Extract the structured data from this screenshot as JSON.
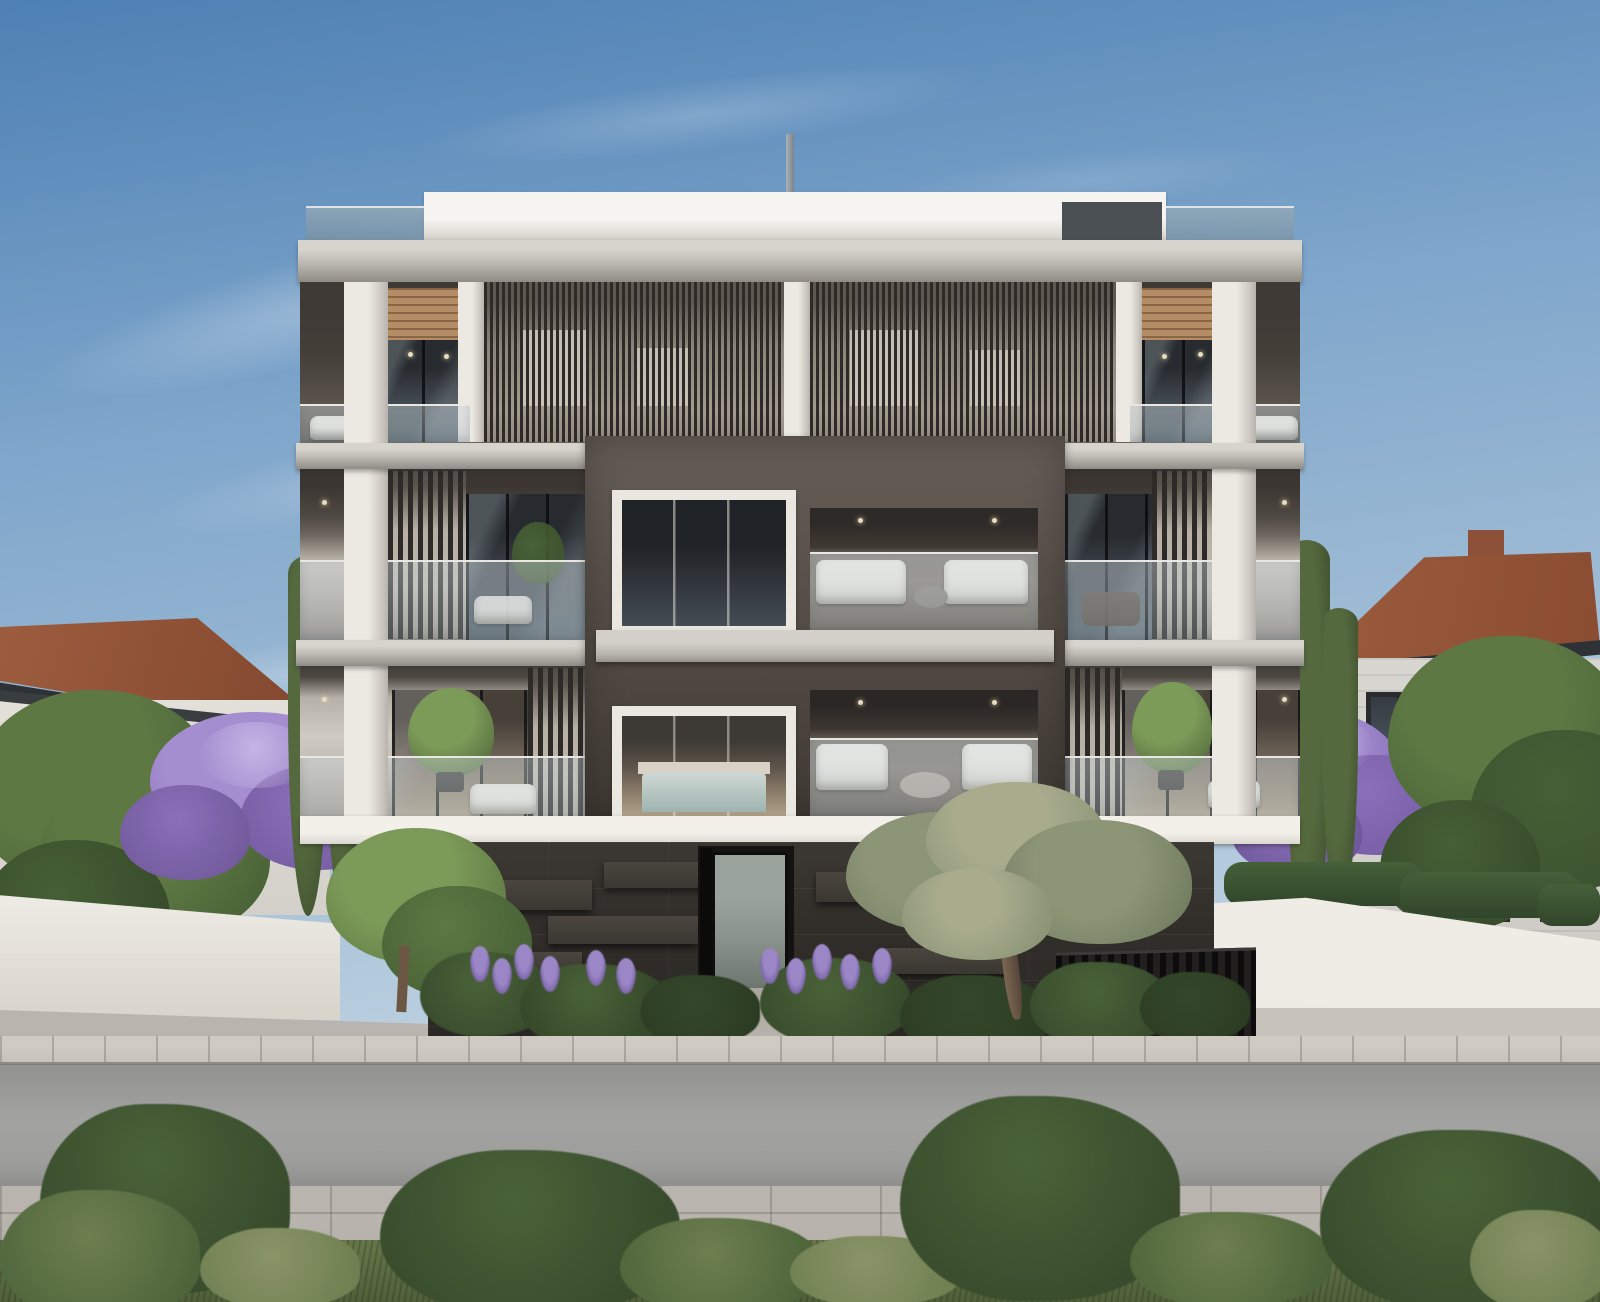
{
  "scene": {
    "type": "photorealistic architectural exterior rendering",
    "subject": "Modern three-storey apartment building with white concrete slabs, dark vertical louvers, timber soffits, glass balustrades and a protruding dark frame volume over a black stone base",
    "setting": "Residential street: neighbouring terracotta-roofed houses left and right, cypress and jacaranda trees, white boundary walls, landscaped front garden with olive tree and lavender, sidewalk, asphalt road and grass verge with shrubs in the foreground",
    "elements": [
      "sky",
      "clouds",
      "antenna pole",
      "roof parapet",
      "glass roof railing",
      "concrete slabs",
      "white columns",
      "timber soffit",
      "vertical louver screens",
      "glass door walls",
      "balcony glass balustrades",
      "balcony sofas",
      "potted trees",
      "central dark frame volume",
      "bedroom windows",
      "bed",
      "balcony lounge furniture",
      "downlights",
      "white fascia",
      "dark stone base",
      "entrance door",
      "entrance walkway",
      "bin enclosure",
      "olive tree",
      "garden bushes",
      "lavender flowers",
      "left house",
      "right house",
      "boundary walls",
      "hedge",
      "cypress trees",
      "jacaranda trees",
      "green trees",
      "driveway",
      "sidewalk",
      "asphalt road",
      "foreground pavement",
      "grass verge",
      "foreground shrubs"
    ],
    "palette": {
      "sky_top": "#4d80b4",
      "sky_mid": "#7fa6cb",
      "sky_low": "#b7cdde",
      "sky_horizon": "#e2e4e0",
      "slab_top": "#d7d4ce",
      "slab_face": "#bcb9b3",
      "slab_shadow": "#8f8c86",
      "column_lit": "#ece9e3",
      "column_shade": "#cdc9c2",
      "white_trim": "#f2efe9",
      "wood": "#b48c66",
      "wood_line": "#8a6647",
      "interior_dark": "#453f3a",
      "interior_warm": "#d9ccba",
      "louver_slat": "#2d2a27",
      "louver_gap": "#c0b9ae",
      "box_frame": "#5b534c",
      "box_frame_dark": "#3f3933",
      "glass_dark": "#272b2f",
      "glass_mid": "#3f464d",
      "balustrade_glass": "#b8c4c9",
      "rail_white": "#e9e7e3",
      "window_frame_white": "#eae7e1",
      "window_frame_dark": "#2a2b2f",
      "base_dark": "#322f2b",
      "base_panel": "#4a463f",
      "entrance_glass": "#8b938d",
      "bin_dark": "#21201f",
      "sidewalk": "#c7c3ba",
      "road": "#9d9d9c",
      "pavement": "#b6b2ab",
      "grass": "#66774a",
      "grass_dark": "#4f603a",
      "shrub_dark": "#35482b",
      "shrub_mid": "#4a6238",
      "shrub_light": "#6e7f50",
      "olive_leaf": "#8d9577",
      "olive_light": "#a8ac8d",
      "olive_dark": "#6f7a5d",
      "trunk": "#6b5743",
      "lavender": "#9b87c6",
      "lavender_deep": "#7f68ad",
      "jacaranda": "#a48ed0",
      "jacaranda_deep": "#8a70ba",
      "jacaranda_light": "#c5b4e4",
      "tree_green": "#5d7843",
      "tree_green_dark": "#465f35",
      "tree_bright": "#7c9a58",
      "cypress": "#55693e",
      "cypress_dark": "#3c4e2d",
      "roof_tile": "#9d5c3e",
      "roof_tile_dark": "#7e452c",
      "fascia": "#2e3236",
      "house_wall": "#e3e0da",
      "house_wall_right": "#d8d6d1",
      "wall_white": "#efece6",
      "wall_shade": "#d8d4cc",
      "driveway": "#c7c3bb",
      "downlight": "#e8dcc0",
      "pole": "#7b838a"
    }
  }
}
